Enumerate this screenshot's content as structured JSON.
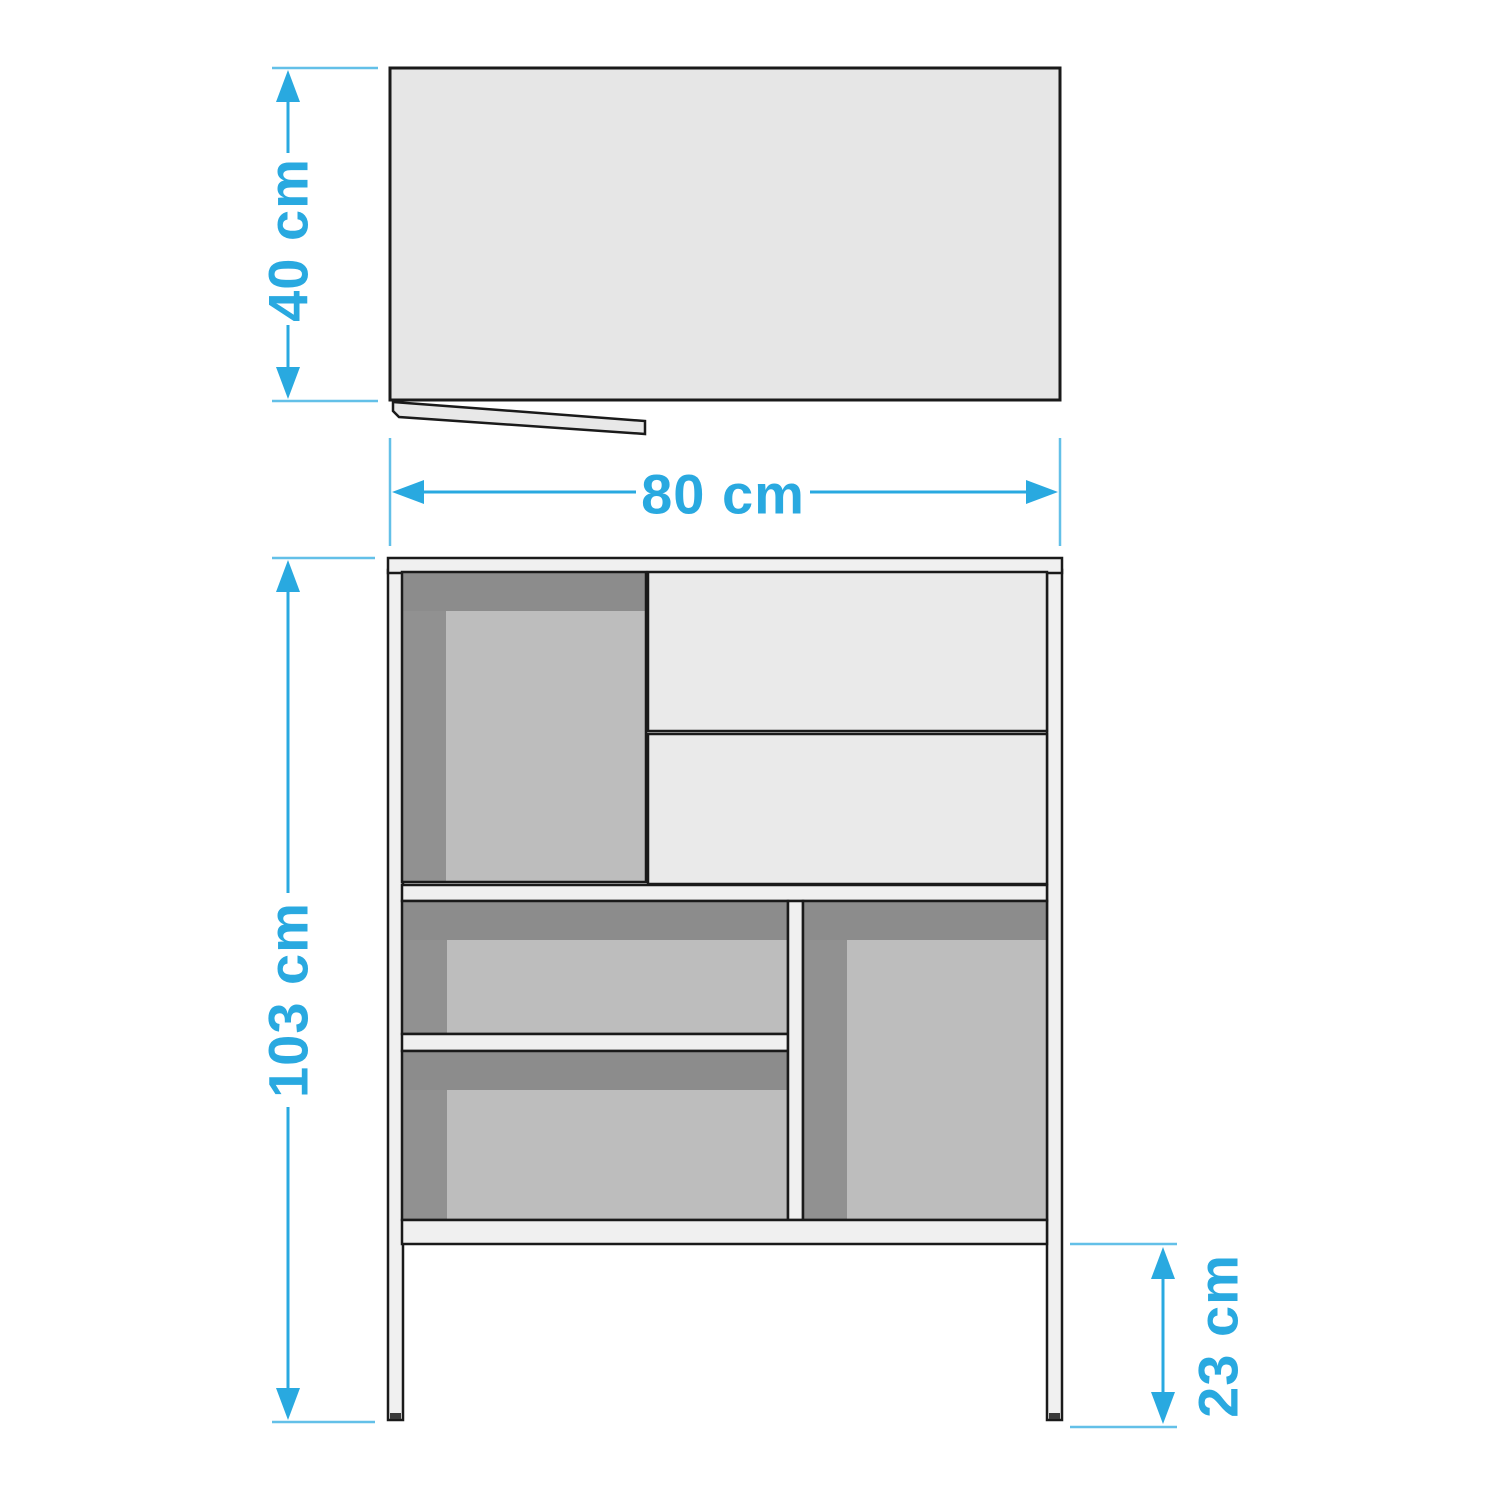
{
  "diagram": {
    "type": "furniture-dimension-drawing",
    "views": {
      "top_view": "top view panel with open door flap",
      "front_view": "front view with open compartments, two drawers and legs"
    },
    "dimensions": {
      "depth": "40 cm",
      "width": "80 cm",
      "height": "103 cm",
      "leg_height": "23 cm"
    },
    "colors": {
      "line": "#1a1a1a",
      "accent": "#29a9e0",
      "accent-light": "#63c0e8",
      "top-view": "#e6e6e6",
      "flap": "#e8e8e8",
      "panel": "#f0f0f0",
      "drawer": "#eaeaea",
      "shadow-band": "#8c8c8c",
      "side-shade": "#919191",
      "interior": "#bdbdbd",
      "leg-foot": "#3a3a3a"
    }
  }
}
